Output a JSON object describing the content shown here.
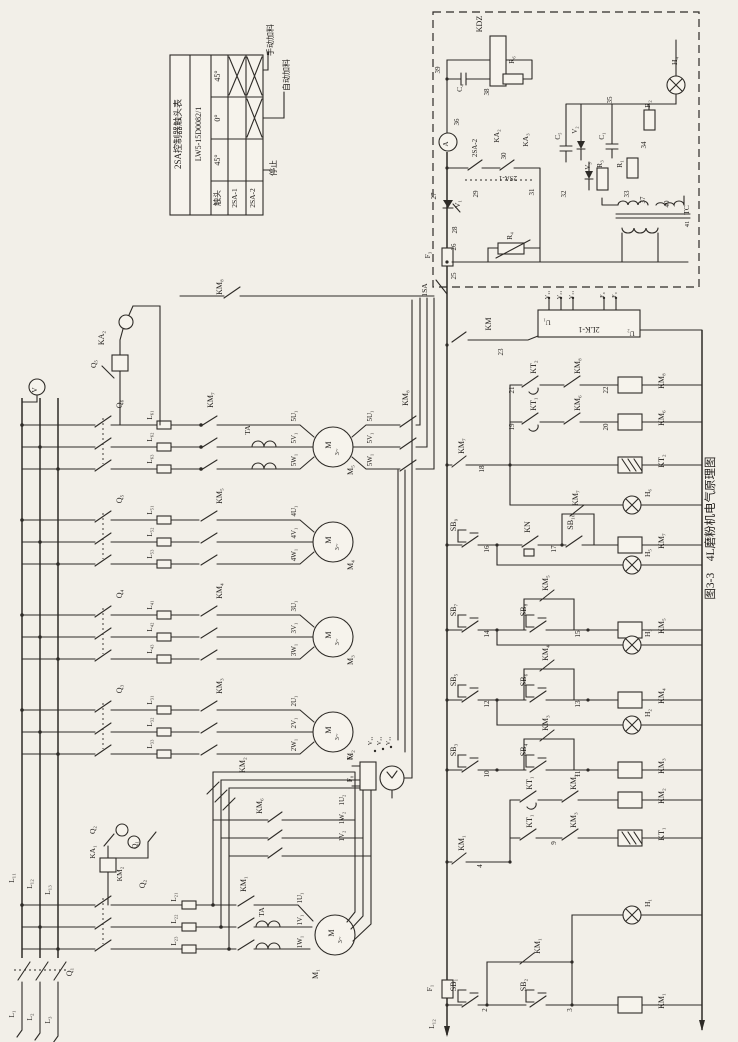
{
  "figure_caption": "图3-3　4L磨粉机电气原理图",
  "contact_table": {
    "title": "2SA控制器触头表",
    "model": "LW5-15D0082/1",
    "columns": [
      "触头",
      "45°",
      "0°",
      "45°"
    ],
    "positions": [
      "手动加料",
      "自动加料",
      "停止"
    ],
    "rows": [
      {
        "name": "2SA-1",
        "marks": [
          "",
          "",
          "×"
        ]
      },
      {
        "name": "2SA-2",
        "marks": [
          "",
          "×",
          "×"
        ]
      }
    ]
  },
  "components": {
    "motors": [
      "M₁",
      "M₂",
      "M₃",
      "M₄",
      "M₅"
    ],
    "contactors": [
      "KM₁",
      "KM₂",
      "KM₃",
      "KM₄",
      "KM₅",
      "KM₆",
      "KM₇",
      "KM₈"
    ],
    "time_relays": [
      "KT₁",
      "KT₂"
    ],
    "current_relays": [
      "KA₁",
      "KA₂",
      "KA₃"
    ],
    "thermal_relay": "KN",
    "buttons": [
      "SB₁",
      "SB₂",
      "SB₃",
      "SB₄",
      "SB₅",
      "SB₆",
      "SB₇",
      "SB₈",
      "SB₉",
      "SB₁₀"
    ],
    "lamps": [
      "H₁",
      "H₂",
      "H₃",
      "H₄",
      "H₅",
      "H₆"
    ],
    "switches": [
      "Q₁",
      "Q₂",
      "Q₃",
      "Q₄",
      "Q₅",
      "Q₆",
      "1SA",
      "2SA-1",
      "2SA-2"
    ],
    "fuses": [
      "F₁",
      "F₃",
      "F₇",
      "F₈",
      "F₉"
    ],
    "other": [
      "KDZ",
      "2LK-1",
      "TC",
      "TA",
      "KA",
      "V",
      "A"
    ]
  },
  "labels": [
    {
      "t": "2SA控制器触头表",
      "x": 181,
      "y": 134,
      "s": 9
    },
    {
      "t": "LW5-15D0082/1",
      "x": 201,
      "y": 134,
      "s": 8
    },
    {
      "t": "45°",
      "x": 220,
      "y": 76
    },
    {
      "t": "0°",
      "x": 220,
      "y": 118
    },
    {
      "t": "45°",
      "x": 220,
      "y": 160
    },
    {
      "t": "触头",
      "x": 220,
      "y": 198
    },
    {
      "t": "2SA-1",
      "x": 237,
      "y": 198,
      "s": 7.5
    },
    {
      "t": "2SA-2",
      "x": 255,
      "y": 198,
      "s": 7.5
    },
    {
      "t": "手动加料",
      "x": 273,
      "y": 40
    },
    {
      "t": "自动加料",
      "x": 289,
      "y": 75
    },
    {
      "t": "停止",
      "x": 276,
      "y": 168
    },
    {
      "t": "图3-3　4L磨粉机电气原理图",
      "x": 714,
      "y": 528,
      "s": 11.5
    },
    {
      "t": "V",
      "x": 37,
      "y": 390,
      "s": 7.5
    },
    {
      "t": "L₁₁",
      "x": 14,
      "y": 878,
      "s": 7.5
    },
    {
      "t": "L₁₂",
      "x": 32,
      "y": 884,
      "s": 7.5
    },
    {
      "t": "L₁₃",
      "x": 50,
      "y": 890,
      "s": 7.5
    },
    {
      "t": "Q₁",
      "x": 72,
      "y": 972
    },
    {
      "t": "L₁",
      "x": 14,
      "y": 1014,
      "s": 7.5
    },
    {
      "t": "L₂",
      "x": 32,
      "y": 1017,
      "s": 7.5
    },
    {
      "t": "L₃",
      "x": 50,
      "y": 1020,
      "s": 7.5
    },
    {
      "t": "Q₆",
      "x": 122,
      "y": 404
    },
    {
      "t": "L₆₁",
      "x": 152,
      "y": 415,
      "s": 7
    },
    {
      "t": "L₆₂",
      "x": 152,
      "y": 437,
      "s": 7
    },
    {
      "t": "L₆₃",
      "x": 152,
      "y": 459,
      "s": 7
    },
    {
      "t": "KM₇",
      "x": 213,
      "y": 400
    },
    {
      "t": "TA",
      "x": 250,
      "y": 430,
      "s": 7.5
    },
    {
      "t": "5U₁",
      "x": 296,
      "y": 416,
      "s": 7
    },
    {
      "t": "5V₁",
      "x": 296,
      "y": 438,
      "s": 7
    },
    {
      "t": "5W₁",
      "x": 296,
      "y": 460,
      "s": 7
    },
    {
      "t": "M",
      "x": 331,
      "y": 445,
      "s": 8
    },
    {
      "t": "3~",
      "x": 339,
      "y": 452,
      "s": 6.5
    },
    {
      "t": "M₅",
      "x": 353,
      "y": 470,
      "s": 8
    },
    {
      "t": "5U₁",
      "x": 372,
      "y": 416,
      "s": 7
    },
    {
      "t": "5V₁",
      "x": 372,
      "y": 438,
      "s": 7
    },
    {
      "t": "5W₁",
      "x": 372,
      "y": 460,
      "s": 7
    },
    {
      "t": "KM₈",
      "x": 408,
      "y": 398
    },
    {
      "t": "KM₈",
      "x": 222,
      "y": 287
    },
    {
      "t": "KA₂",
      "x": 104,
      "y": 338
    },
    {
      "t": "Q₅",
      "x": 96,
      "y": 364,
      "s": 7.5
    },
    {
      "t": "Q₅",
      "x": 122,
      "y": 499
    },
    {
      "t": "L₅₁",
      "x": 152,
      "y": 510,
      "s": 7
    },
    {
      "t": "L₅₂",
      "x": 152,
      "y": 532,
      "s": 7
    },
    {
      "t": "L₅₃",
      "x": 152,
      "y": 554,
      "s": 7
    },
    {
      "t": "KM₅",
      "x": 222,
      "y": 496
    },
    {
      "t": "4U₁",
      "x": 296,
      "y": 511,
      "s": 7
    },
    {
      "t": "4V₁",
      "x": 296,
      "y": 533,
      "s": 7
    },
    {
      "t": "4W₁",
      "x": 296,
      "y": 555,
      "s": 7
    },
    {
      "t": "M",
      "x": 331,
      "y": 540,
      "s": 8
    },
    {
      "t": "3~",
      "x": 339,
      "y": 547,
      "s": 6.5
    },
    {
      "t": "M₄",
      "x": 353,
      "y": 565,
      "s": 8
    },
    {
      "t": "Q₄",
      "x": 122,
      "y": 594
    },
    {
      "t": "L₄₁",
      "x": 152,
      "y": 605,
      "s": 7
    },
    {
      "t": "L₄₂",
      "x": 152,
      "y": 627,
      "s": 7
    },
    {
      "t": "L₄₃",
      "x": 152,
      "y": 649,
      "s": 7
    },
    {
      "t": "KM₄",
      "x": 222,
      "y": 591
    },
    {
      "t": "3U₁",
      "x": 296,
      "y": 606,
      "s": 7
    },
    {
      "t": "3V₁",
      "x": 296,
      "y": 628,
      "s": 7
    },
    {
      "t": "3W₁",
      "x": 296,
      "y": 650,
      "s": 7
    },
    {
      "t": "M",
      "x": 331,
      "y": 635,
      "s": 8
    },
    {
      "t": "3~",
      "x": 339,
      "y": 642,
      "s": 6.5
    },
    {
      "t": "M₃",
      "x": 353,
      "y": 660,
      "s": 8
    },
    {
      "t": "Q₃",
      "x": 122,
      "y": 689
    },
    {
      "t": "L₃₁",
      "x": 152,
      "y": 700,
      "s": 7
    },
    {
      "t": "L₃₂",
      "x": 152,
      "y": 722,
      "s": 7
    },
    {
      "t": "L₃₃",
      "x": 152,
      "y": 744,
      "s": 7
    },
    {
      "t": "KM₃",
      "x": 222,
      "y": 686
    },
    {
      "t": "2U₁",
      "x": 296,
      "y": 701,
      "s": 7
    },
    {
      "t": "2V₁",
      "x": 296,
      "y": 723,
      "s": 7
    },
    {
      "t": "2W₁",
      "x": 296,
      "y": 745,
      "s": 7
    },
    {
      "t": "M",
      "x": 331,
      "y": 730,
      "s": 8
    },
    {
      "t": "3~",
      "x": 339,
      "y": 737,
      "s": 6.5
    },
    {
      "t": "M₂",
      "x": 353,
      "y": 755,
      "s": 8
    },
    {
      "t": "Q₂",
      "x": 145,
      "y": 884
    },
    {
      "t": "L₂₁",
      "x": 176,
      "y": 897,
      "s": 7
    },
    {
      "t": "L₂₂",
      "x": 176,
      "y": 919,
      "s": 7
    },
    {
      "t": "L₂₃",
      "x": 176,
      "y": 941,
      "s": 7
    },
    {
      "t": "KM₁",
      "x": 246,
      "y": 884
    },
    {
      "t": "TA",
      "x": 264,
      "y": 912,
      "s": 7.5
    },
    {
      "t": "1U₁",
      "x": 302,
      "y": 898,
      "s": 7
    },
    {
      "t": "1V₁",
      "x": 302,
      "y": 920,
      "s": 7
    },
    {
      "t": "1W₁",
      "x": 302,
      "y": 942,
      "s": 7
    },
    {
      "t": "M",
      "x": 334,
      "y": 933,
      "s": 8
    },
    {
      "t": "3~",
      "x": 342,
      "y": 940,
      "s": 6.5
    },
    {
      "t": "M₁",
      "x": 318,
      "y": 974,
      "s": 8
    },
    {
      "t": "KM₂",
      "x": 245,
      "y": 765
    },
    {
      "t": "KM₆",
      "x": 262,
      "y": 806
    },
    {
      "t": "1U₂",
      "x": 344,
      "y": 800,
      "s": 7
    },
    {
      "t": "1W₂",
      "x": 344,
      "y": 818,
      "s": 7
    },
    {
      "t": "1V₂",
      "x": 344,
      "y": 836,
      "s": 7
    },
    {
      "t": "Q₂",
      "x": 95,
      "y": 830,
      "s": 7.5
    },
    {
      "t": "KA₁",
      "x": 95,
      "y": 852,
      "s": 7.5
    },
    {
      "t": "Q₁",
      "x": 137,
      "y": 845,
      "s": 7.5
    },
    {
      "t": "KM₂",
      "x": 122,
      "y": 874,
      "s": 7.5
    },
    {
      "t": "F₇",
      "x": 352,
      "y": 757,
      "s": 7
    },
    {
      "t": "F₈",
      "x": 352,
      "y": 779,
      "s": 7
    },
    {
      "t": "V₁₁",
      "x": 372,
      "y": 741,
      "s": 6
    },
    {
      "t": "V₂₁",
      "x": 381,
      "y": 741,
      "s": 6
    },
    {
      "t": "V₃₁",
      "x": 390,
      "y": 741,
      "s": 6
    },
    {
      "t": "KDZ",
      "x": 482,
      "y": 24
    },
    {
      "t": "39",
      "x": 440,
      "y": 70,
      "s": 7
    },
    {
      "t": "C₄",
      "x": 462,
      "y": 88,
      "s": 7.5
    },
    {
      "t": "38",
      "x": 489,
      "y": 92,
      "s": 7
    },
    {
      "t": "R₆",
      "x": 514,
      "y": 60,
      "s": 7.5
    },
    {
      "t": "36",
      "x": 459,
      "y": 122,
      "s": 7
    },
    {
      "t": "A",
      "x": 448,
      "y": 144,
      "s": 7
    },
    {
      "t": "27",
      "x": 436,
      "y": 196,
      "s": 7
    },
    {
      "t": "V₁",
      "x": 460,
      "y": 204,
      "s": 7.5
    },
    {
      "t": "28",
      "x": 457,
      "y": 230,
      "s": 7
    },
    {
      "t": "26",
      "x": 456,
      "y": 247,
      "s": 7
    },
    {
      "t": "F₃",
      "x": 430,
      "y": 255,
      "s": 7.5
    },
    {
      "t": "25",
      "x": 456,
      "y": 276,
      "s": 7
    },
    {
      "t": "1SA",
      "x": 427,
      "y": 290,
      "s": 7.5
    },
    {
      "t": "KA₂",
      "x": 499,
      "y": 136,
      "s": 7.5
    },
    {
      "t": "KA₃",
      "x": 528,
      "y": 140,
      "s": 7.5
    },
    {
      "t": "2SA-2",
      "x": 477,
      "y": 148,
      "s": 7
    },
    {
      "t": "2SA-1",
      "x": 508,
      "y": 176,
      "s": 7,
      "r": 180
    },
    {
      "t": "29",
      "x": 478,
      "y": 194,
      "s": 7
    },
    {
      "t": "30",
      "x": 506,
      "y": 156,
      "s": 7
    },
    {
      "t": "31",
      "x": 534,
      "y": 192,
      "s": 7
    },
    {
      "t": "R₄",
      "x": 512,
      "y": 236,
      "s": 7.5
    },
    {
      "t": "C₅",
      "x": 560,
      "y": 136,
      "s": 7
    },
    {
      "t": "V₂",
      "x": 577,
      "y": 130,
      "s": 7
    },
    {
      "t": "V₃",
      "x": 590,
      "y": 166,
      "s": 7
    },
    {
      "t": "32",
      "x": 566,
      "y": 194,
      "s": 7
    },
    {
      "t": "R₃",
      "x": 602,
      "y": 164,
      "s": 7.5
    },
    {
      "t": "C₁",
      "x": 604,
      "y": 136,
      "s": 7
    },
    {
      "t": "33",
      "x": 629,
      "y": 194,
      "s": 7
    },
    {
      "t": "37",
      "x": 645,
      "y": 200,
      "s": 7
    },
    {
      "t": "40",
      "x": 669,
      "y": 204,
      "s": 7
    },
    {
      "t": "TC",
      "x": 689,
      "y": 210,
      "s": 7.5
    },
    {
      "t": "41",
      "x": 689,
      "y": 224,
      "s": 6.5
    },
    {
      "t": "35",
      "x": 612,
      "y": 100,
      "s": 7
    },
    {
      "t": "R₂",
      "x": 650,
      "y": 104,
      "s": 7.5
    },
    {
      "t": "34",
      "x": 646,
      "y": 145,
      "s": 7
    },
    {
      "t": "R₁",
      "x": 622,
      "y": 164,
      "s": 7.5
    },
    {
      "t": "H₄",
      "x": 677,
      "y": 61,
      "s": 7.5
    },
    {
      "t": "KM",
      "x": 491,
      "y": 324
    },
    {
      "t": "23",
      "x": 503,
      "y": 352,
      "s": 7
    },
    {
      "t": "2LK-1",
      "x": 589,
      "y": 327,
      "r": 180
    },
    {
      "t": "U₁",
      "x": 547,
      "y": 320,
      "s": 7,
      "r": 180
    },
    {
      "t": "U₂",
      "x": 631,
      "y": 331,
      "s": 7,
      "r": 180
    },
    {
      "t": "V₁₁",
      "x": 549,
      "y": 295,
      "s": 6
    },
    {
      "t": "V₂₁",
      "x": 561,
      "y": 295,
      "s": 6
    },
    {
      "t": "V₃₁",
      "x": 573,
      "y": 295,
      "s": 6
    },
    {
      "t": "F₈",
      "x": 604,
      "y": 295,
      "s": 6
    },
    {
      "t": "F₉",
      "x": 616,
      "y": 295,
      "s": 6
    },
    {
      "t": "KM₇",
      "x": 464,
      "y": 446
    },
    {
      "t": "18",
      "x": 484,
      "y": 469,
      "s": 7
    },
    {
      "t": "KT₂",
      "x": 536,
      "y": 367
    },
    {
      "t": "21",
      "x": 514,
      "y": 390,
      "s": 7
    },
    {
      "t": "KM₈",
      "x": 580,
      "y": 366
    },
    {
      "t": "KM₈",
      "x": 664,
      "y": 381
    },
    {
      "t": "22",
      "x": 608,
      "y": 390,
      "s": 7
    },
    {
      "t": "KT₁",
      "x": 536,
      "y": 404
    },
    {
      "t": "19",
      "x": 514,
      "y": 427,
      "s": 7
    },
    {
      "t": "KM₆",
      "x": 580,
      "y": 403
    },
    {
      "t": "KM₆",
      "x": 664,
      "y": 418
    },
    {
      "t": "20",
      "x": 608,
      "y": 427,
      "s": 7
    },
    {
      "t": "KT₂",
      "x": 664,
      "y": 461
    },
    {
      "t": "H₆",
      "x": 650,
      "y": 493,
      "s": 7.5
    },
    {
      "t": "SB₉",
      "x": 456,
      "y": 525
    },
    {
      "t": "16",
      "x": 489,
      "y": 549,
      "s": 7
    },
    {
      "t": "KN",
      "x": 530,
      "y": 527
    },
    {
      "t": "17",
      "x": 556,
      "y": 549,
      "s": 7
    },
    {
      "t": "SB₁₀",
      "x": 573,
      "y": 522
    },
    {
      "t": "KM₇",
      "x": 578,
      "y": 498
    },
    {
      "t": "KM₇",
      "x": 664,
      "y": 541
    },
    {
      "t": "H₅",
      "x": 650,
      "y": 553,
      "s": 7.5
    },
    {
      "t": "SB₇",
      "x": 456,
      "y": 610
    },
    {
      "t": "14",
      "x": 489,
      "y": 634,
      "s": 7
    },
    {
      "t": "SB₈",
      "x": 526,
      "y": 610
    },
    {
      "t": "15",
      "x": 580,
      "y": 634,
      "s": 7
    },
    {
      "t": "KM₅",
      "x": 548,
      "y": 583
    },
    {
      "t": "KM₅",
      "x": 664,
      "y": 626
    },
    {
      "t": "H₃",
      "x": 650,
      "y": 633,
      "s": 7.5
    },
    {
      "t": "SB₅",
      "x": 456,
      "y": 680
    },
    {
      "t": "12",
      "x": 489,
      "y": 704,
      "s": 7
    },
    {
      "t": "SB₆",
      "x": 526,
      "y": 680
    },
    {
      "t": "13",
      "x": 580,
      "y": 704,
      "s": 7
    },
    {
      "t": "KM₄",
      "x": 548,
      "y": 653
    },
    {
      "t": "KM₄",
      "x": 664,
      "y": 696
    },
    {
      "t": "H₂",
      "x": 650,
      "y": 713,
      "s": 7.5
    },
    {
      "t": "SB₃",
      "x": 456,
      "y": 750
    },
    {
      "t": "10",
      "x": 489,
      "y": 774,
      "s": 7
    },
    {
      "t": "SB₄",
      "x": 526,
      "y": 750
    },
    {
      "t": "11",
      "x": 580,
      "y": 774,
      "s": 7
    },
    {
      "t": "KM₃",
      "x": 548,
      "y": 723
    },
    {
      "t": "KM₃",
      "x": 664,
      "y": 766
    },
    {
      "t": "KM₁",
      "x": 464,
      "y": 843
    },
    {
      "t": "4",
      "x": 482,
      "y": 866,
      "s": 7
    },
    {
      "t": "KT₁",
      "x": 532,
      "y": 783
    },
    {
      "t": "KM₂",
      "x": 576,
      "y": 782
    },
    {
      "t": "KM₂",
      "x": 664,
      "y": 796
    },
    {
      "t": "KT₁",
      "x": 532,
      "y": 821
    },
    {
      "t": "9",
      "x": 556,
      "y": 843,
      "s": 7
    },
    {
      "t": "KM₃",
      "x": 576,
      "y": 820
    },
    {
      "t": "KT₁",
      "x": 664,
      "y": 834
    },
    {
      "t": "KM₁",
      "x": 540,
      "y": 946
    },
    {
      "t": "H₁",
      "x": 650,
      "y": 903,
      "s": 7.5
    },
    {
      "t": "SB₁",
      "x": 456,
      "y": 985
    },
    {
      "t": "2",
      "x": 487,
      "y": 1010,
      "s": 7
    },
    {
      "t": "SB₂",
      "x": 526,
      "y": 985
    },
    {
      "t": "3",
      "x": 572,
      "y": 1010,
      "s": 7
    },
    {
      "t": "KM₁",
      "x": 664,
      "y": 1001
    },
    {
      "t": "F₁",
      "x": 432,
      "y": 988,
      "s": 7.5
    },
    {
      "t": "L₁₂",
      "x": 434,
      "y": 1024,
      "s": 7.5
    }
  ]
}
